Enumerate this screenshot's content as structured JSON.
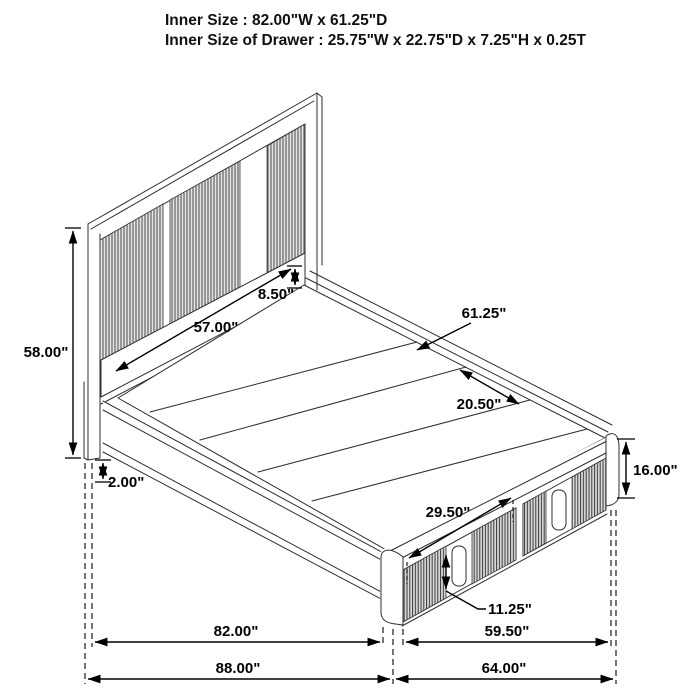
{
  "header": {
    "line1": "Inner Size : 82.00\"W x 61.25\"D",
    "line2": "Inner Size of Drawer : 25.75\"W x 22.75\"D x 7.25\"H x 0.25T"
  },
  "diagram": {
    "subject": "storage platform bed with footboard drawers",
    "view": "isometric line drawing",
    "dimensions": {
      "headboard_height": "58.00\"",
      "headboard_rail_height": "8.50\"",
      "headboard_inner_width": "57.00\"",
      "platform_inner_depth": "61.25\"",
      "platform_section_depth": "20.50\"",
      "footboard_height": "16.00\"",
      "rail_floor_clearance": "2.00\"",
      "drawer_width": "29.50\"",
      "drawer_front_height": "11.25\"",
      "inner_length": "82.00\"",
      "footboard_inner_width": "59.50\"",
      "overall_length": "88.00\"",
      "overall_width": "64.00\""
    }
  }
}
